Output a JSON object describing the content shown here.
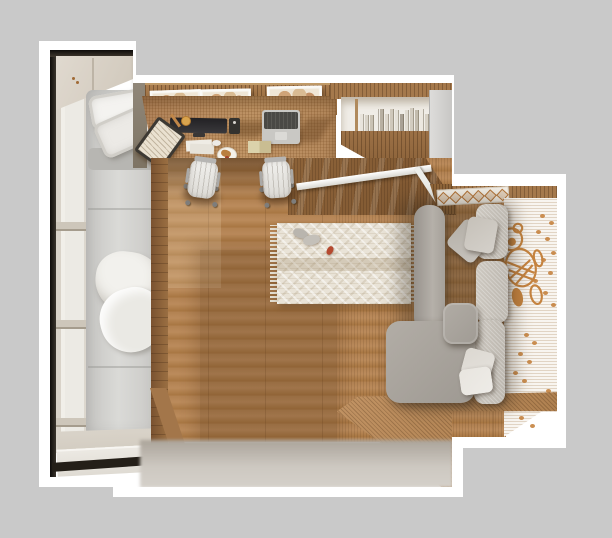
{
  "scene": {
    "description": "photorealistic 3d render, top-down cross-section view of a small apartment bedroom with home office",
    "zones": [
      "balcony-bed",
      "desk-office",
      "bookcase",
      "wood-floor",
      "kids-sofa-corner"
    ],
    "no_visible_text": true
  },
  "palette": {
    "background": "#c9c9c9",
    "outline_white": "#ffffff",
    "floor_wood": "#b28252",
    "desk_wood": "#bb8f60",
    "slat_wall": "#9b7045",
    "mattress_gray": "#d5d4d1",
    "duvet_white": "#f1f0ec",
    "sofa_gray": "#a6a19b",
    "sofa_cushion": "#c8c3bb",
    "rug_cream": "#e9e3d7",
    "wallpaper_white": "#f8f5f0",
    "wallpaper_orange": "#c5833f",
    "window_frame_black": "#17140f"
  },
  "decor": {
    "picture_frames": [
      {
        "x": 150,
        "y": 90,
        "w": 47,
        "h": 16,
        "rot": -2
      },
      {
        "x": 200,
        "y": 89,
        "w": 47,
        "h": 16,
        "rot": -1
      },
      {
        "x": 267,
        "y": 86,
        "w": 51,
        "h": 17,
        "rot": -1
      }
    ],
    "book_spines": [
      "#e8e4dc",
      "#d9d4c9",
      "#c9c2b4",
      "#efece6",
      "#b8b0a2",
      "#ded8cd",
      "#cfc8bb",
      "#e5e1d8",
      "#a9a195",
      "#e0dbd1",
      "#d2ccc0",
      "#c3bcae",
      "#ece8e0",
      "#d8d2c6",
      "#beb6a8",
      "#e4e0d7"
    ],
    "window_bars_y": [
      222,
      320,
      418
    ],
    "band_diamond_count": 6,
    "wallpaper_dots": [
      [
        540,
        214
      ],
      [
        549,
        221
      ],
      [
        536,
        230
      ],
      [
        545,
        237
      ],
      [
        551,
        251
      ],
      [
        541,
        258
      ],
      [
        548,
        271
      ],
      [
        533,
        279
      ],
      [
        543,
        291
      ],
      [
        551,
        303
      ],
      [
        524,
        333
      ],
      [
        532,
        341
      ],
      [
        518,
        352
      ],
      [
        527,
        360
      ],
      [
        513,
        371
      ],
      [
        522,
        379
      ],
      [
        546,
        389
      ],
      [
        538,
        402
      ],
      [
        519,
        416
      ],
      [
        530,
        424
      ]
    ],
    "rug_toys": [
      {
        "x": 293,
        "y": 229,
        "w": 15,
        "h": 9,
        "rot": 20,
        "color": "#b9b5ae"
      },
      {
        "x": 303,
        "y": 235,
        "w": 17,
        "h": 10,
        "rot": -12,
        "color": "#c4c0b9"
      },
      {
        "x": 327,
        "y": 246,
        "w": 6,
        "h": 9,
        "rot": 28,
        "color": "#b5492f"
      }
    ],
    "sofa_pillows": [
      {
        "x": 452,
        "y": 224,
        "w": 34,
        "h": 34,
        "rot": 40,
        "color": "#b3aea6"
      },
      {
        "x": 466,
        "y": 218,
        "w": 30,
        "h": 34,
        "rot": 10,
        "color": "#c6c1b9"
      },
      {
        "x": 463,
        "y": 350,
        "w": 30,
        "h": 28,
        "rot": 15,
        "color": "#dcd8d1"
      },
      {
        "x": 460,
        "y": 368,
        "w": 32,
        "h": 26,
        "rot": -8,
        "color": "#e8e5df"
      }
    ]
  }
}
